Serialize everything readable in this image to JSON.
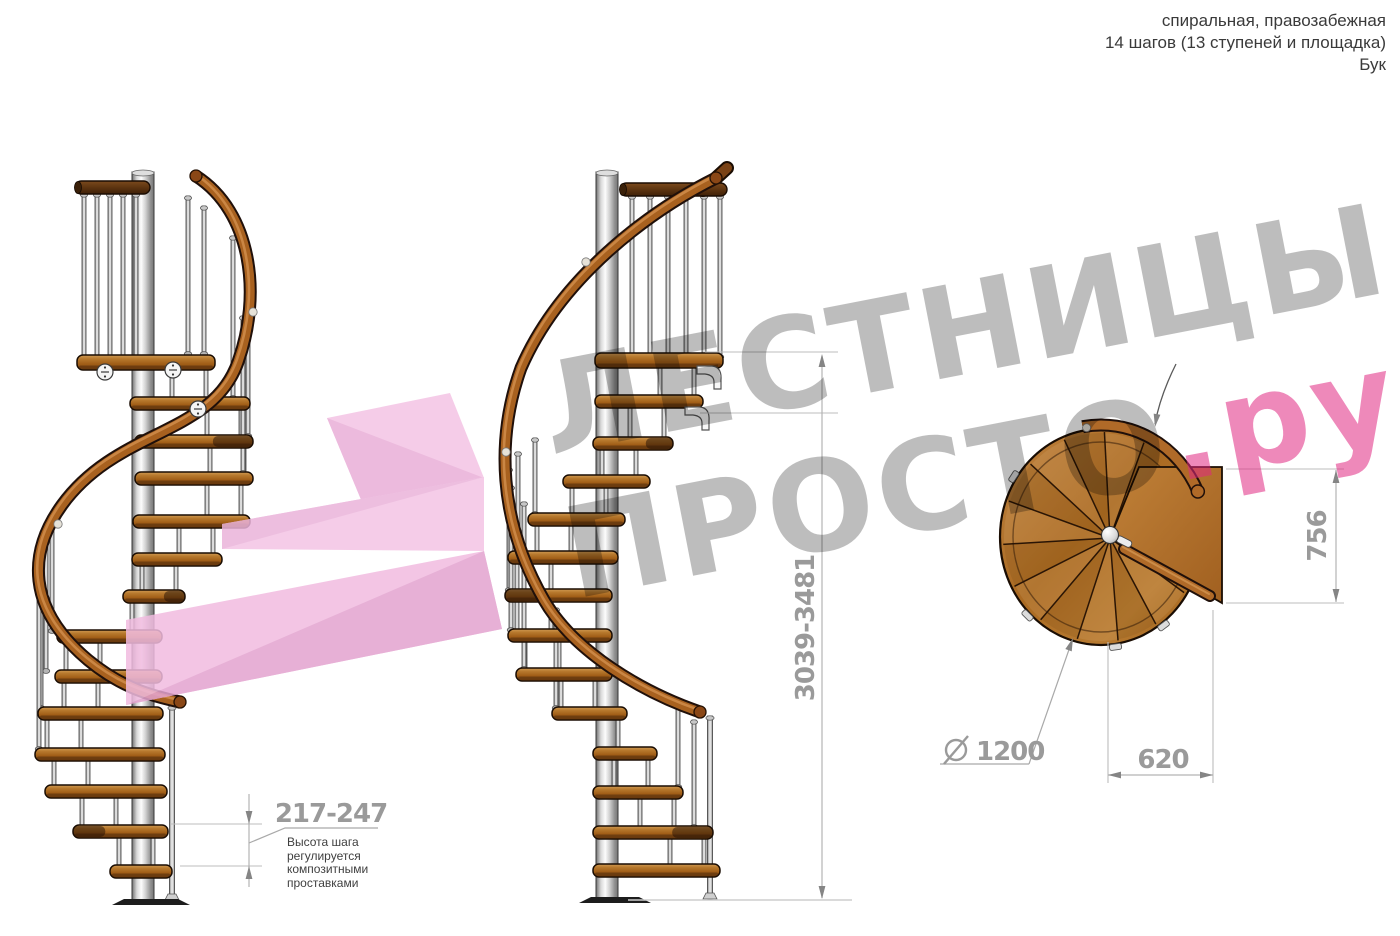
{
  "header": {
    "line1": "спиральная, правозабежная",
    "line2": "14 шагов (13 ступеней и площадка)",
    "line3": "Бук"
  },
  "watermark": {
    "line1": "ЛЕСТНИЦЫ",
    "line2": "ПРОСТО",
    "line2_suffix": ".ру"
  },
  "dims": {
    "total_height": "3039-3481",
    "step_height": "217-247",
    "step_note": [
      "Высота шага",
      "регулируется",
      "композитными",
      "проставками"
    ],
    "plan_depth": "756",
    "plan_width": "620",
    "diameter_value": "1200"
  },
  "colors": {
    "wood": "#b06c24",
    "wood_dark": "#5d3410",
    "rail": "#a8611f",
    "metal_pole": "#d8d8d8",
    "pink_arrow": "#f1bce0",
    "watermark_gray": "#bdbdbd",
    "watermark_pink": "#ee8abc",
    "dim_text": "#9a9a9a",
    "dim_line": "#b3b3b3",
    "header_text": "#3a3a3a"
  },
  "figures": {
    "left_stair": {
      "name": "left-elevation-view",
      "pole": [
        143,
        172,
        903
      ],
      "base": [
        116,
        186,
        899
      ],
      "top_rail": [
        75,
        150,
        181
      ],
      "rail": "M196,176 C252,212 262,295 238,362 C212,436 118,428 62,505 C28,552 26,608 88,660 C122,688 152,696 180,702",
      "rail_ends": [
        [
          196,
          176
        ],
        [
          180,
          702
        ]
      ],
      "rail_bands": [
        [
          253,
          312
        ],
        [
          58,
          524
        ]
      ],
      "platform_rods": [
        84,
        97,
        110,
        123,
        136
      ],
      "extra_rods": [
        [
          188,
          196,
          353
        ],
        [
          204,
          206,
          353
        ]
      ],
      "tall_rods": [
        [
          233,
          236,
          397
        ],
        [
          248,
          286,
          435
        ],
        [
          243,
          316,
          472
        ],
        [
          52,
          514,
          630
        ],
        [
          46,
          530,
          670
        ],
        [
          41,
          548,
          707
        ],
        [
          39,
          566,
          748
        ]
      ],
      "end_post": [
        172,
        706,
        897
      ],
      "treads": [
        [
          355,
          77,
          215,
          0,
          1
        ],
        [
          397,
          130,
          250
        ],
        [
          435,
          135,
          253,
          1
        ],
        [
          472,
          135,
          253
        ],
        [
          515,
          133,
          250
        ],
        [
          553,
          132,
          222
        ],
        [
          590,
          123,
          185,
          1
        ],
        [
          630,
          57,
          162
        ],
        [
          670,
          55,
          162
        ],
        [
          707,
          38,
          163
        ],
        [
          748,
          35,
          165
        ],
        [
          785,
          45,
          167
        ],
        [
          825,
          73,
          168,
          1
        ],
        [
          865,
          110,
          172
        ]
      ],
      "discs": [
        [
          105,
          372
        ],
        [
          173,
          370
        ],
        [
          198,
          409
        ]
      ],
      "brackets": []
    },
    "center_stair": {
      "name": "center-elevation-view",
      "pole": [
        607,
        172,
        901
      ],
      "base": [
        583,
        647,
        897
      ],
      "top_rail": [
        620,
        727,
        183
      ],
      "diag_rail": [
        703,
        190,
        727,
        168
      ],
      "rail": "M716,178 C648,212 560,278 521,368 C496,438 498,520 544,600 C574,652 642,692 700,712",
      "rail_ends": [
        [
          716,
          178
        ],
        [
          700,
          712
        ]
      ],
      "rail_bands": [
        [
          586,
          262
        ],
        [
          506,
          452
        ]
      ],
      "platform_rods": [
        632,
        650,
        668,
        686,
        704,
        720
      ],
      "extra_rods": [],
      "tall_rods": [
        [
          535,
          438,
          513
        ],
        [
          518,
          452,
          551
        ],
        [
          509,
          468,
          589
        ],
        [
          511,
          486,
          629
        ],
        [
          524,
          502,
          668
        ],
        [
          556,
          608,
          707
        ],
        [
          678,
          700,
          786
        ],
        [
          694,
          720,
          826
        ]
      ],
      "end_post": [
        710,
        716,
        896
      ],
      "treads": [
        [
          353,
          595,
          723,
          0,
          1
        ],
        [
          395,
          595,
          703
        ],
        [
          437,
          593,
          673,
          1
        ],
        [
          475,
          563,
          650
        ],
        [
          513,
          528,
          625
        ],
        [
          551,
          508,
          618
        ],
        [
          589,
          505,
          612,
          1
        ],
        [
          629,
          508,
          612
        ],
        [
          668,
          516,
          612
        ],
        [
          707,
          552,
          627
        ],
        [
          747,
          593,
          657
        ],
        [
          786,
          593,
          683
        ],
        [
          826,
          593,
          713,
          1
        ],
        [
          864,
          593,
          720
        ]
      ],
      "discs": [],
      "brackets": [
        [
          706,
          366
        ],
        [
          694,
          407
        ]
      ]
    },
    "plan": {
      "name": "plan-view",
      "cx": 1101,
      "cy": 537,
      "rx": 101,
      "ry": 108,
      "hub": [
        1110,
        538
      ],
      "platform": [
        [
          1110,
          538
        ],
        [
          1139,
          467
        ],
        [
          1222,
          467
        ],
        [
          1222,
          603
        ]
      ],
      "sector_start": 32,
      "sector_end": 296,
      "sector_step": 24,
      "notches": [
        53,
        82,
        135,
        213
      ],
      "rail_bar": [
        1124,
        549,
        1210,
        596
      ],
      "arc": [
        106,
        112,
        -100,
        -24
      ],
      "ball": [
        1110,
        535
      ]
    }
  }
}
